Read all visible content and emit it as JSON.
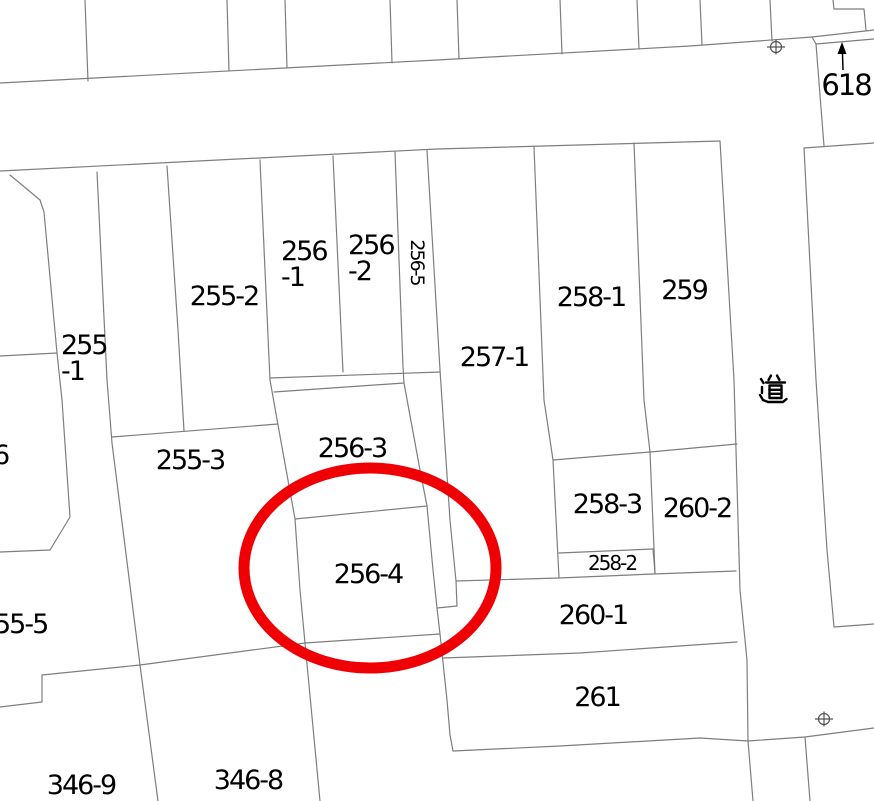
{
  "map": {
    "type": "japanese-cadastral-map",
    "background": "#ffffff",
    "boundary_line_color": "#7e7e7e",
    "label_color": "#000000",
    "parcel_labels": [
      {
        "id": "618",
        "text": "618",
        "x": 846,
        "y": 85,
        "size": 29
      },
      {
        "id": "255-1",
        "lines": [
          "255",
          "-1"
        ],
        "x": 61,
        "y": 333,
        "anchor": "tl"
      },
      {
        "id": "255-2",
        "text": "255-2",
        "x": 224,
        "y": 297
      },
      {
        "id": "256-1",
        "lines": [
          "256",
          "-1"
        ],
        "x": 281,
        "y": 239,
        "anchor": "tl"
      },
      {
        "id": "256-2",
        "lines": [
          "256",
          "-2"
        ],
        "x": 348,
        "y": 233,
        "anchor": "tl"
      },
      {
        "id": "256-5",
        "text": "256-5",
        "x": 417,
        "y": 262,
        "rotate": 90,
        "size": 19
      },
      {
        "id": "257-1",
        "text": "257-1",
        "x": 494,
        "y": 358
      },
      {
        "id": "258-1",
        "text": "258-1",
        "x": 591,
        "y": 298
      },
      {
        "id": "259",
        "text": "259",
        "x": 684,
        "y": 291
      },
      {
        "id": "255-3",
        "text": "255-3",
        "x": 190,
        "y": 461
      },
      {
        "id": "256-3",
        "text": "256-3",
        "x": 352,
        "y": 449
      },
      {
        "id": "256-4",
        "text": "256-4",
        "x": 368,
        "y": 575
      },
      {
        "id": "258-3",
        "text": "258-3",
        "x": 607,
        "y": 505
      },
      {
        "id": "260-2",
        "text": "260-2",
        "x": 697,
        "y": 509
      },
      {
        "id": "258-2",
        "text": "258-2",
        "x": 612,
        "y": 563,
        "size": 20
      },
      {
        "id": "260-1",
        "text": "260-1",
        "x": 593,
        "y": 616
      },
      {
        "id": "261",
        "text": "261",
        "x": 597,
        "y": 698
      },
      {
        "id": "346-9",
        "text": "346-9",
        "x": 81,
        "y": 786
      },
      {
        "id": "346-8",
        "text": "346-8",
        "x": 248,
        "y": 781
      },
      {
        "id": "55-5",
        "text": "55-5",
        "x": -6,
        "y": 612,
        "anchor": "tl"
      },
      {
        "id": "6",
        "text": "6",
        "x": -7,
        "y": 443,
        "anchor": "tl"
      }
    ],
    "road_label": {
      "text": "道",
      "x": 772,
      "y": 390
    },
    "highlight": {
      "shape": "ellipse",
      "highlighted_parcel": "256-4",
      "cx": 370,
      "cy": 568,
      "rx": 126,
      "ry": 100,
      "color": "#ee0005",
      "stroke_width": 11
    },
    "survey_markers": [
      {
        "type": "benchmark-circle-cross",
        "x": 776,
        "y": 47
      },
      {
        "type": "benchmark-circle-cross",
        "x": 824,
        "y": 719
      }
    ],
    "north_arrow": {
      "x": 842,
      "y": 43,
      "direction": "up"
    }
  }
}
